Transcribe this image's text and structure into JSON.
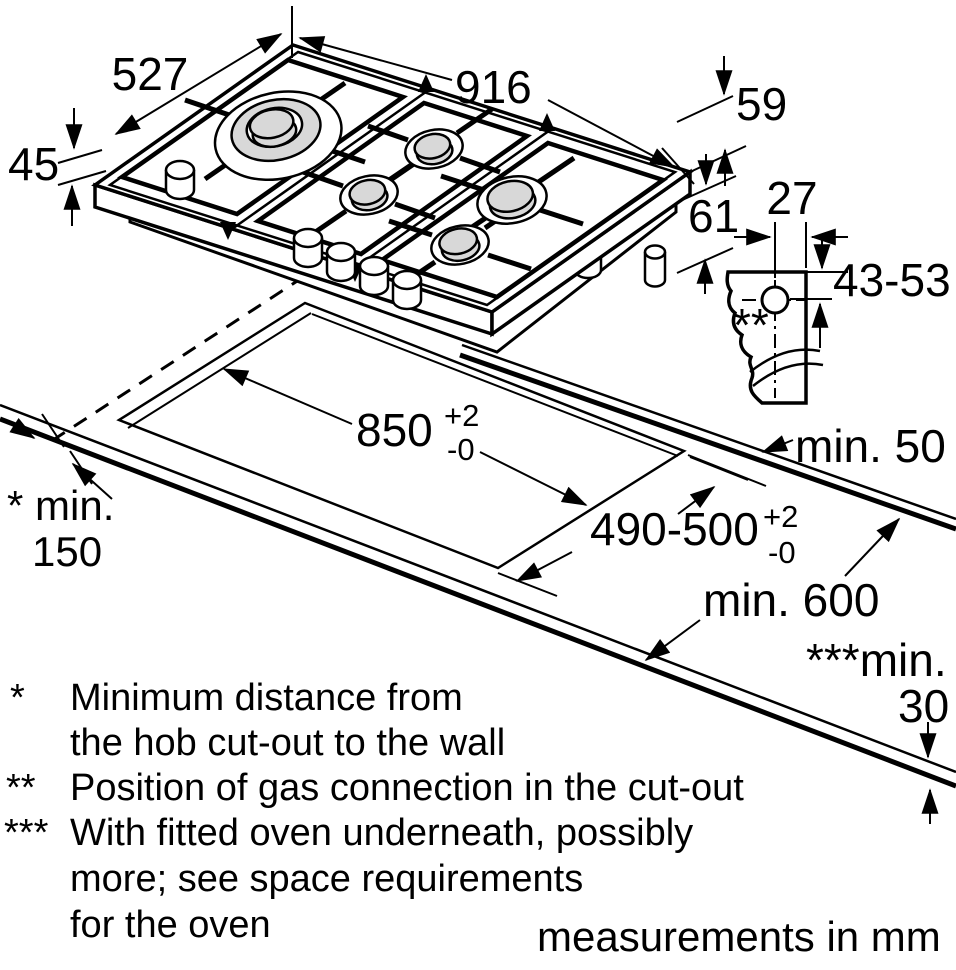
{
  "diagram": {
    "hob": {
      "width_label": "527",
      "length_label": "916",
      "height_above_label": "45",
      "height_mid_label": "59",
      "height_total_label": "61"
    },
    "gas_connection": {
      "offset_x_label": "27",
      "offset_y_label": "43-53",
      "marker": "**"
    },
    "cutout": {
      "length": "850",
      "length_tol_plus": "+2",
      "length_tol_minus": "-0",
      "width": "490-500",
      "width_tol_plus": "+2",
      "width_tol_minus": "-0"
    },
    "clearances": {
      "back": "min. 50",
      "wall_prefix": "* min.",
      "wall_value": "150",
      "front": "min. 600",
      "thickness_prefix": "***min.",
      "thickness_value": "30"
    },
    "footnote_markers": {
      "first": "*",
      "second": "**",
      "third": "***"
    },
    "footnote_lines": [
      {
        "text": "Minimum distance from"
      },
      {
        "text": "the hob cut-out to the wall"
      },
      {
        "text": "Position of gas connection in the cut-out"
      },
      {
        "text": "With fitted oven underneath, possibly"
      },
      {
        "text": "more; see space requirements"
      },
      {
        "text": "for the oven"
      }
    ],
    "unit_note": "measurements in mm"
  },
  "colors": {
    "ink": "#000000",
    "paper": "#ffffff",
    "burner_fill": "#d8d8d8"
  }
}
